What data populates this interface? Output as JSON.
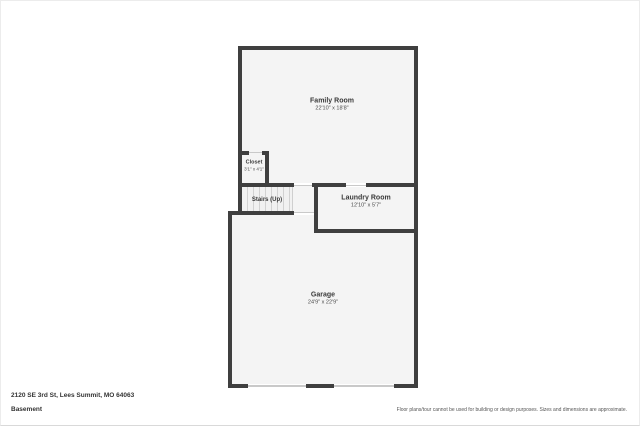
{
  "plan": {
    "rooms": [
      {
        "name": "Family Room",
        "dims": "22'10\" x 18'8\""
      },
      {
        "name": "Closet",
        "dims": "3'1\" x 4'1\""
      },
      {
        "name": "Stairs (Up)",
        "dims": ""
      },
      {
        "name": "Laundry Room",
        "dims": "12'10\" x 5'7\""
      },
      {
        "name": "Garage",
        "dims": "24'9\" x 22'9\""
      }
    ],
    "colors": {
      "wall": "#3f3f3f",
      "room_fill": "#f4f4f4",
      "opening_line": "#c9c9c9"
    }
  },
  "footer": {
    "address": "2120 SE 3rd St, Lees Summit, MO 64063",
    "level": "Basement",
    "disclaimer": "Floor plans/tour cannot be used for building or design purposes. Sizes and dimensions are approximate."
  }
}
